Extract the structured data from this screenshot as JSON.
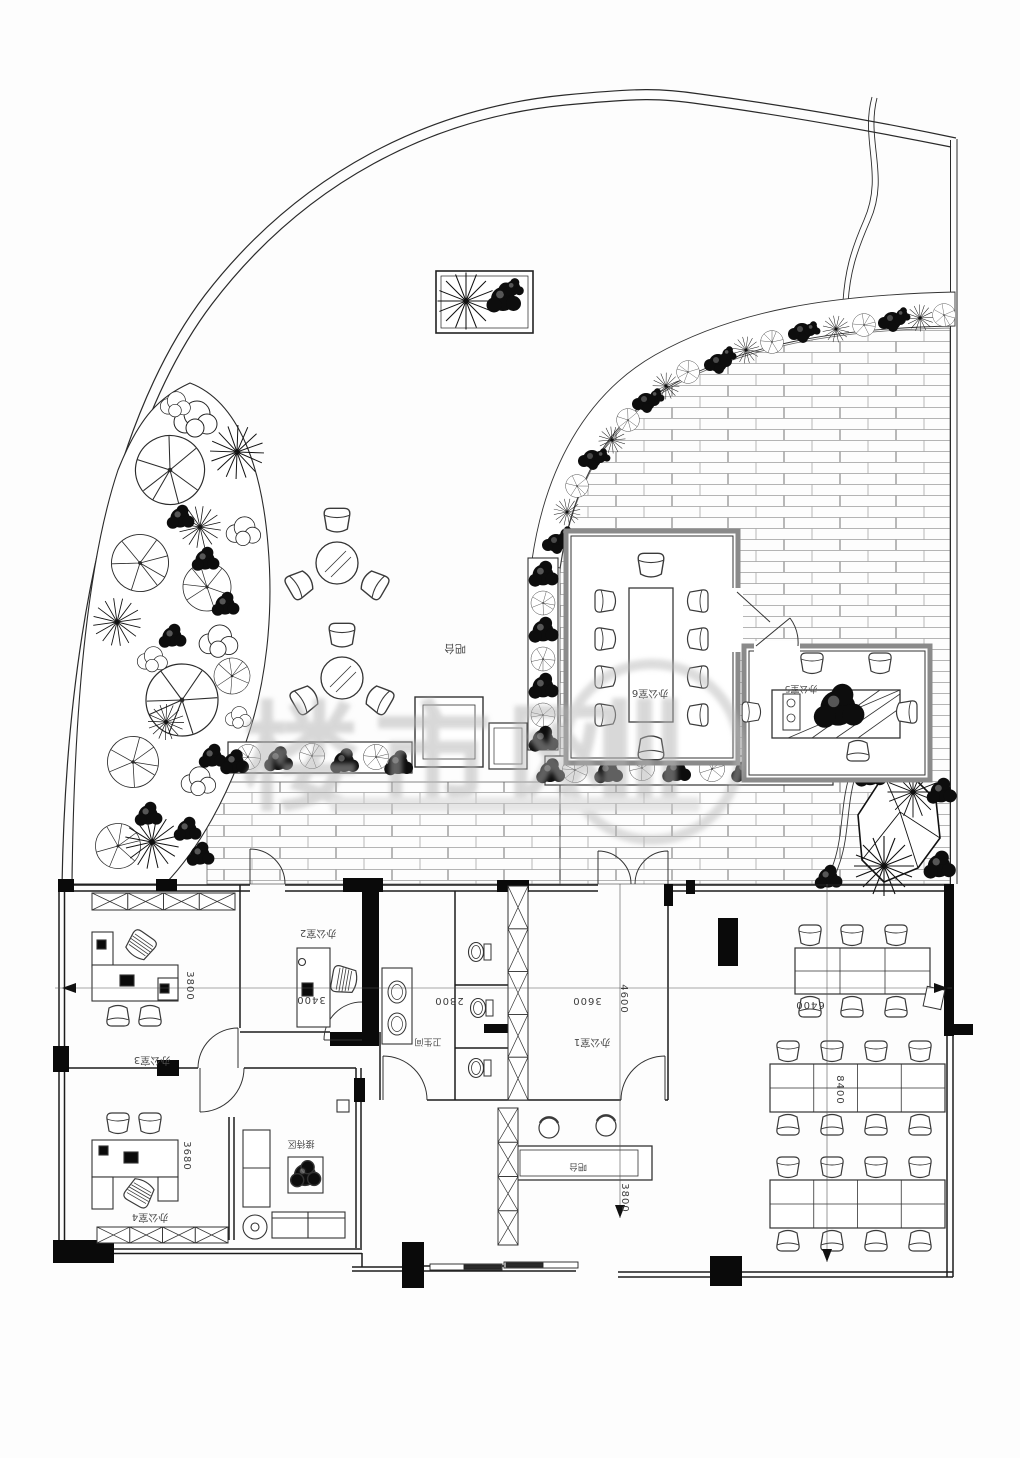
{
  "document": {
    "type": "architectural-floor-plan",
    "language": "zh"
  },
  "labels": {
    "office1": "办公室1",
    "office2": "办公室2",
    "office3": "办公室3",
    "office4": "办公室4",
    "office5": "办公室5",
    "office6": "办公室6",
    "toilet": "卫生间",
    "reception_area": "接待区",
    "bar_terrace": "吧台",
    "bar_lobby": "吧台"
  },
  "dimensions": {
    "d3800a": "3800",
    "d3680": "3680",
    "d3400": "3400",
    "d2800": "2800",
    "d3600": "3600",
    "d4600": "4600",
    "d6400": "6400",
    "d8400": "8400",
    "d3800b": "3800"
  },
  "watermark": {
    "text": "楼市网",
    "icon": "magnifier-icon"
  },
  "colors": {
    "line": "#1c1c1c",
    "wall_gray": "#8a8a8a",
    "paving": "#9b9b9b",
    "watermark": "#b3b3b3"
  }
}
